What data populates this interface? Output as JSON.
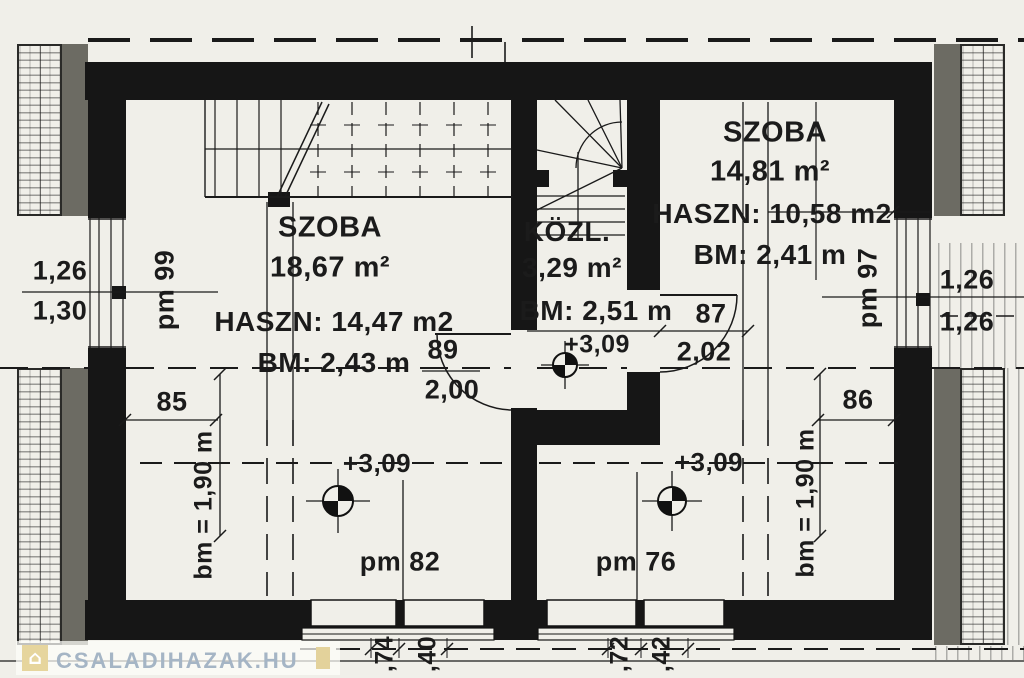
{
  "watermark": {
    "text": "CSALADIHAZAK.HU"
  },
  "rooms": {
    "left": {
      "name": "SZOBA",
      "area": "18,67 m²",
      "haszn": "HASZN: 14,47 m2",
      "bm": "BM: 2,43 m",
      "level": "+3,09",
      "pm": "pm 82",
      "pm_wall": "pm 99",
      "knee": "bm = 1,90 m"
    },
    "corridor": {
      "name": "KÖZL.",
      "area": "3,29 m²",
      "bm": "BM: 2,51 m",
      "level": "+3,09"
    },
    "right": {
      "name": "SZOBA",
      "area": "14,81 m²",
      "haszn": "HASZN: 10,58 m2",
      "bm": "BM: 2,41 m",
      "level": "+3,09",
      "pm": "pm 76",
      "pm_wall": "pm 97",
      "knee": "bm = 1,90 m"
    }
  },
  "dims": {
    "left_wall_top": "1,26",
    "left_wall_bottom": "1,30",
    "right_wall_top": "1,26",
    "right_wall_bottom": "1,26",
    "left_span": "85",
    "right_span": "86",
    "door_left_code": "89",
    "door_left_width": "2,00",
    "door_right_code": "87",
    "door_right_width": "2,02",
    "window_left_a": ",74",
    "window_left_b": ",40",
    "window_right_a": ",72",
    "window_right_b": ",42"
  },
  "colors": {
    "wall": "#161616",
    "paper": "#f0efe9",
    "gray": "#6c6b63",
    "watermark": "#a5b5c5"
  }
}
